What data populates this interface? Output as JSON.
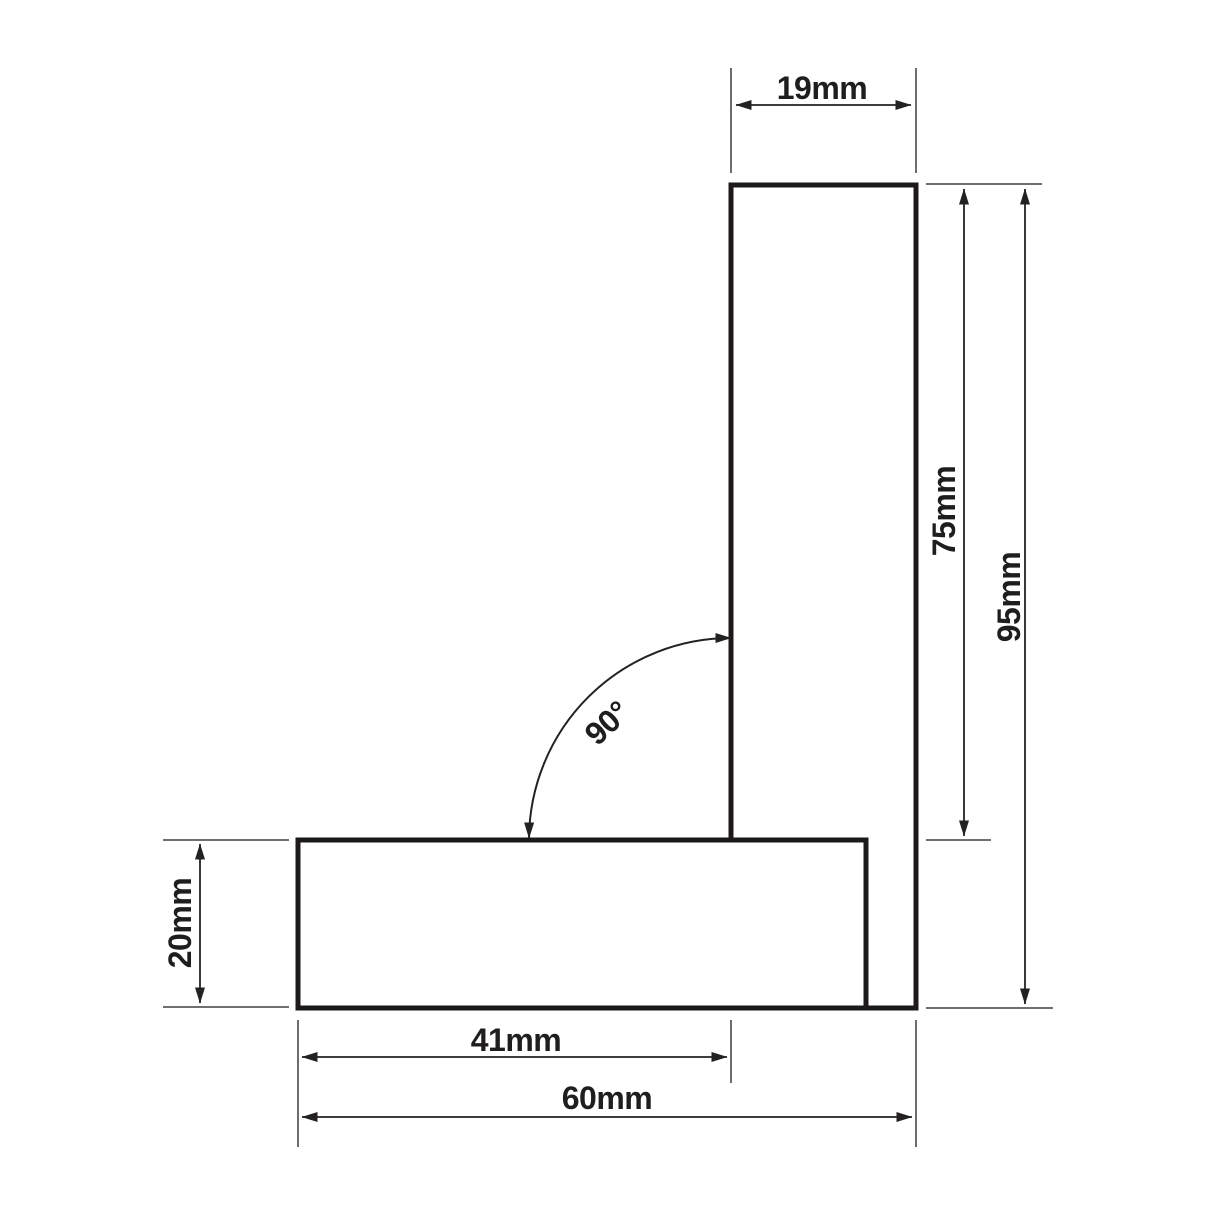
{
  "diagram": {
    "labels": {
      "blade_width": "19mm",
      "blade_length": "75mm",
      "overall_height": "95mm",
      "stock_thickness": "20mm",
      "inner_width": "41mm",
      "stock_length": "60mm",
      "angle": "90°"
    },
    "colors": {
      "background": "#ffffff",
      "outline": "#1c191a",
      "dimension_line": "#242122",
      "extension_line": "#5c5c5c",
      "label_text": "#201d1e"
    }
  }
}
